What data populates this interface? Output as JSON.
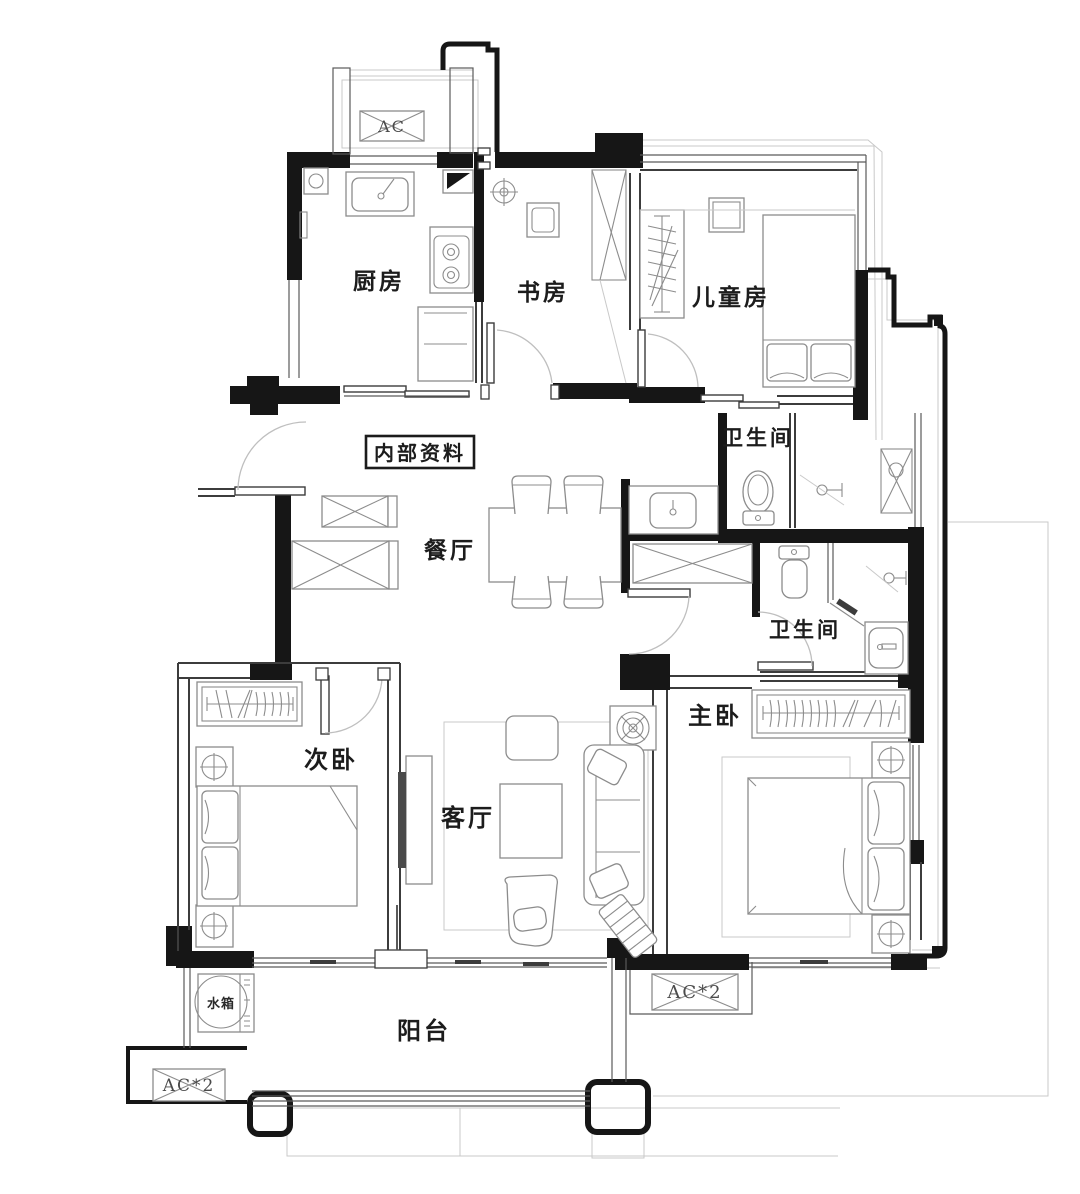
{
  "plan": {
    "watermark": "内部资料",
    "rooms": [
      {
        "id": "kitchen",
        "label": "厨房"
      },
      {
        "id": "study",
        "label": "书房"
      },
      {
        "id": "kids-room",
        "label": "儿童房"
      },
      {
        "id": "bathroom-upper",
        "label": "卫生间"
      },
      {
        "id": "dining",
        "label": "餐厅"
      },
      {
        "id": "bathroom-lower",
        "label": "卫生间"
      },
      {
        "id": "second-bedroom",
        "label": "次卧"
      },
      {
        "id": "living",
        "label": "客厅"
      },
      {
        "id": "master-bedroom",
        "label": "主卧"
      },
      {
        "id": "balcony",
        "label": "阳台"
      }
    ],
    "equipment": {
      "water_tank": "水箱",
      "ac_left": "AC*2",
      "ac_right": "AC*2",
      "ac_top": "AC"
    },
    "colors": {
      "wall": "#161616",
      "furniture_line": "#8c8c8c",
      "swing_arc": "#bfbfbf"
    }
  }
}
